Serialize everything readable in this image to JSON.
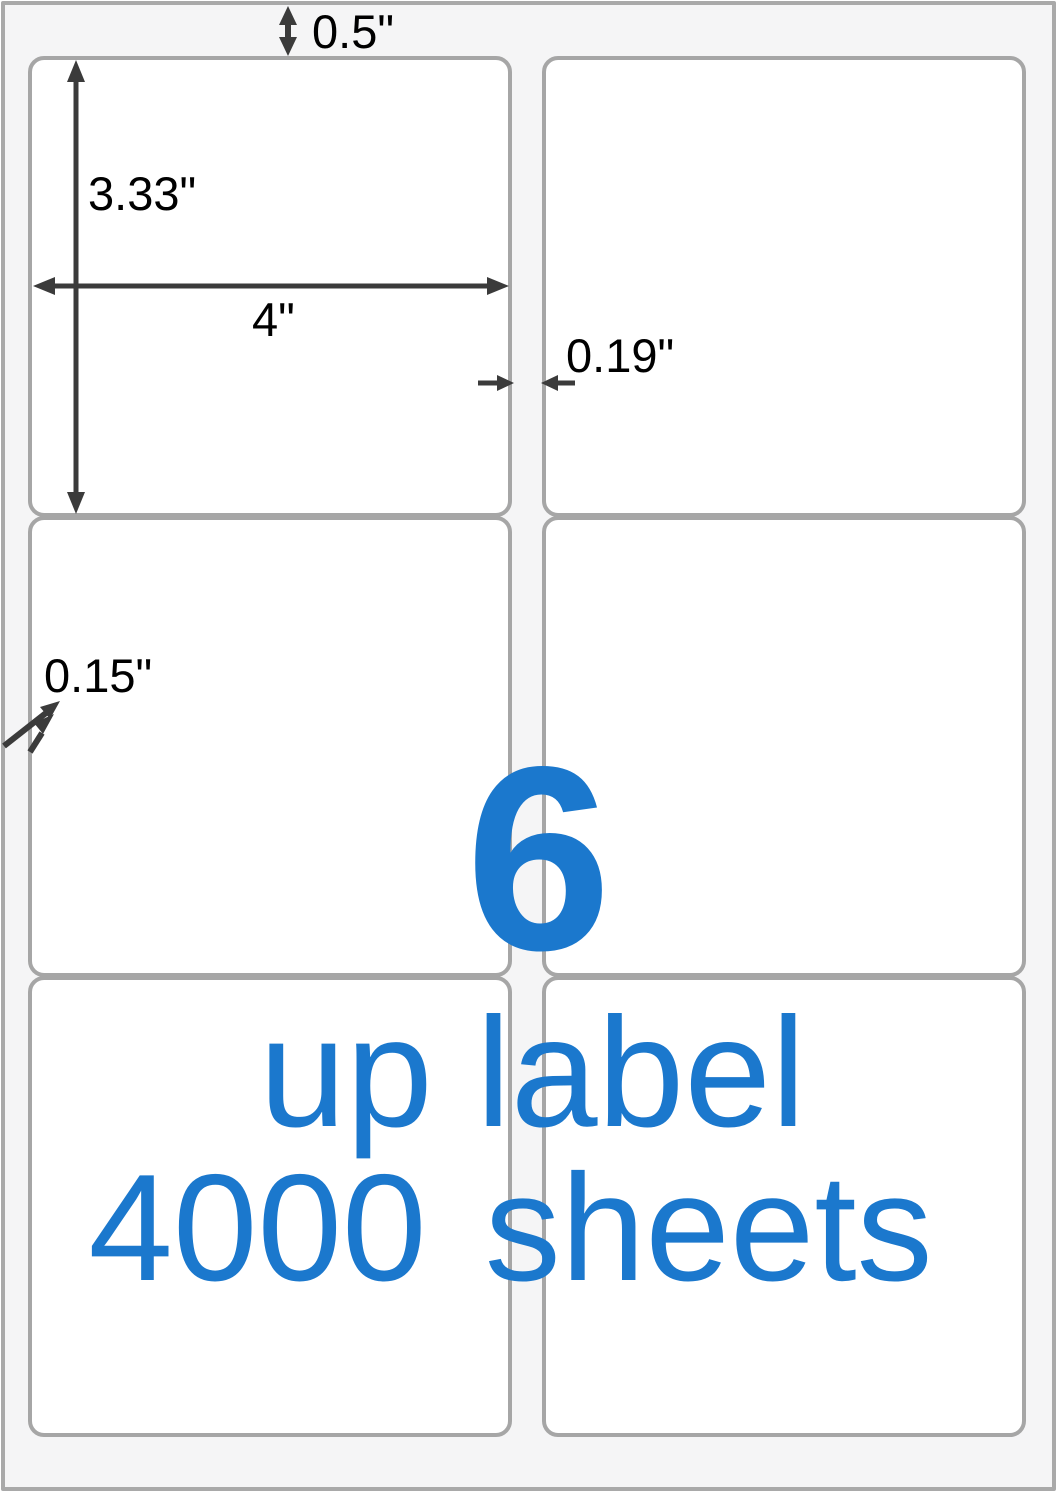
{
  "sheet": {
    "rows": 3,
    "columns": 2,
    "background": "#f5f5f6",
    "border_color": "#a9a9a9",
    "label_background": "#ffffff",
    "label_border_color": "#a6a6a6"
  },
  "annotations": {
    "top_margin": "0.5\"",
    "label_height": "3.33\"",
    "label_width": "4\"",
    "column_gap": "0.19\"",
    "side_margin": "0.15\""
  },
  "headline": {
    "count": "6",
    "line1": "up label",
    "line2": "4000 sheets",
    "color": "#1b78cd"
  },
  "colors": {
    "accent_blue": "#1b78cd",
    "arrow": "#3b3b3b",
    "dimension_text": "#000000"
  }
}
